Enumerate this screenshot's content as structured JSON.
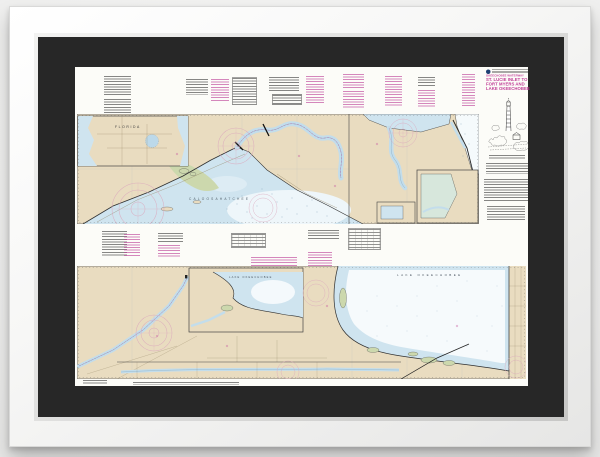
{
  "artwork": {
    "kind": "Framed nautical chart print, white frame with black mat",
    "title_block": {
      "series_label": "OKEECHOBEE WATERWAY",
      "title_line1": "ST. LUCIE INLET TO",
      "title_line2": "FORT MYERS AND",
      "title_line3": "LAKE OKEECHOBEE"
    },
    "labels": {
      "state_inset": "FLORIDA",
      "upper_water": "CALOOSAHATCHEE",
      "lake": "LAKE OKEECHOBEE",
      "lake_inset": "LAKE OKEECHOBEE"
    },
    "colors": {
      "land_tan": "#e9dcc0",
      "water_shallow": "#cfe4ef",
      "water_deep_pale": "#f6fafc",
      "marsh_green": "#ccd8ad",
      "ink_black": "#3a3a3a",
      "ink_magenta": "#c03c96",
      "compass_rose_pink": "#dba8bd",
      "mat_black": "#272727",
      "frame_white": "#f6f6f5",
      "backdrop_gray": "#efefee"
    }
  }
}
